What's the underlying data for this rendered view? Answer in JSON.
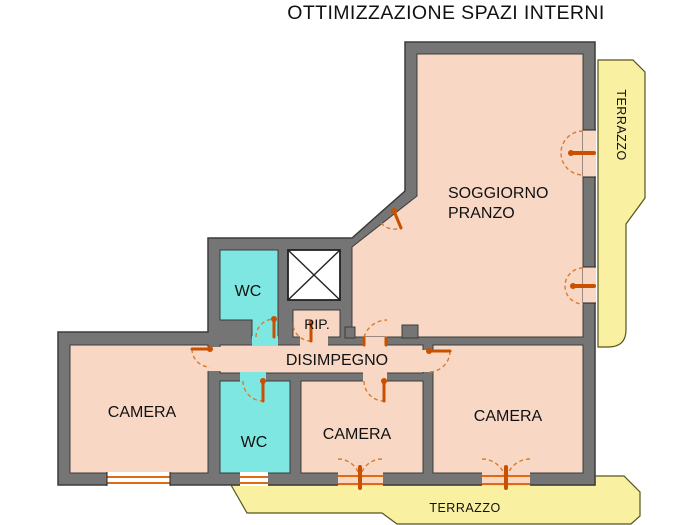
{
  "title": "OTTIMIZZAZIONE SPAZI INTERNI",
  "rooms": {
    "soggiorno_line1": "SOGGIORNO",
    "soggiorno_line2": "PRANZO",
    "wc_top": "WC",
    "rip": "RIP.",
    "disimpegno": "DISIMPEGNO",
    "camera_left": "CAMERA",
    "wc_bottom": "WC",
    "camera_middle": "CAMERA",
    "camera_right": "CAMERA",
    "terrace_right": "TERRAZZO",
    "terrace_bottom": "TERRAZZO"
  },
  "colors": {
    "background": "#ffffff",
    "room_fill": "#f8d8c5",
    "wet_room_fill": "#7fe7e1",
    "terrace_fill": "#f9f0a2",
    "wall_fill": "#757575",
    "wall_outline": "#3c3c3c",
    "shaft_fill": "#ffffff",
    "door_color": "#c85000",
    "door_arc_color": "#d97b2e",
    "window_color": "#e06a10",
    "text_color": "#111111"
  }
}
